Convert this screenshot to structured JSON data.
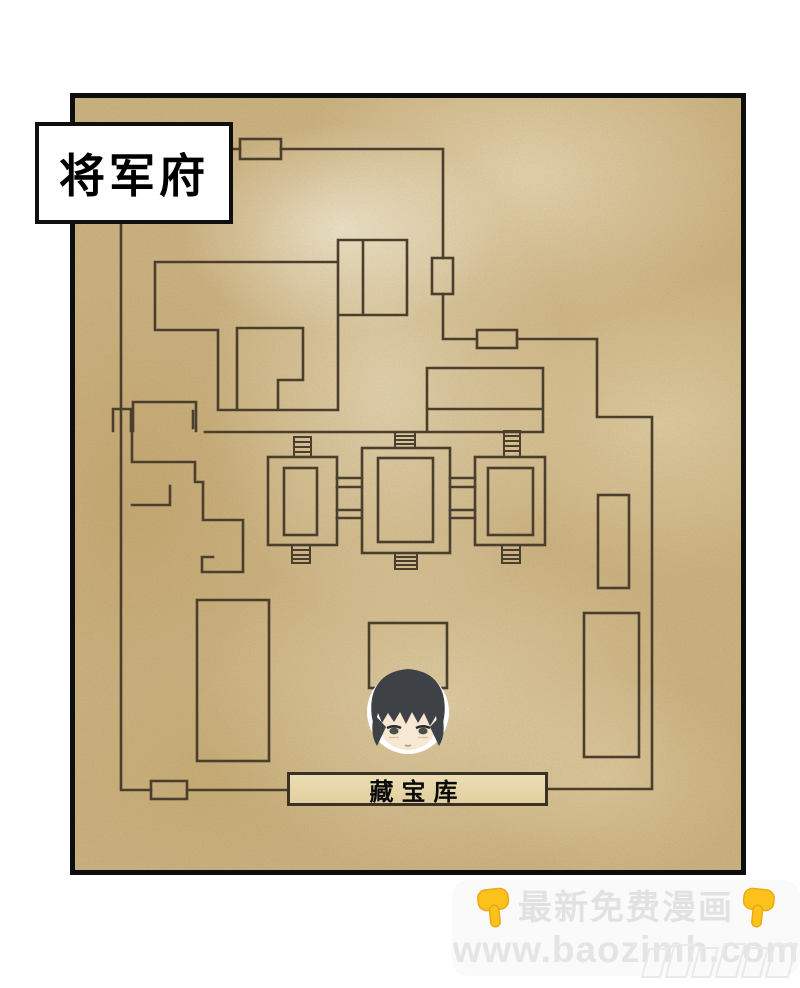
{
  "panel": {
    "title_label": "将军府",
    "vault_label": "藏宝库"
  },
  "watermark": {
    "line1": "最新免费漫画",
    "line2": "www.baozimh.com"
  },
  "colors": {
    "parchment_base": "#d3ba88",
    "parchment_light": "#f3ecd4",
    "plan_line": "#4a3e2d",
    "frame_black": "#0e0e0e",
    "title_box_bg": "#ffffff",
    "title_text": "#000000",
    "vault_box_bg": "#e7d7ab",
    "watermark_text": "#e2e2e2",
    "hand_yellow": "#fcc21b",
    "character_hair": "#3e4145",
    "character_skin": "#f6e8d2",
    "character_outline": "#ffffff"
  }
}
